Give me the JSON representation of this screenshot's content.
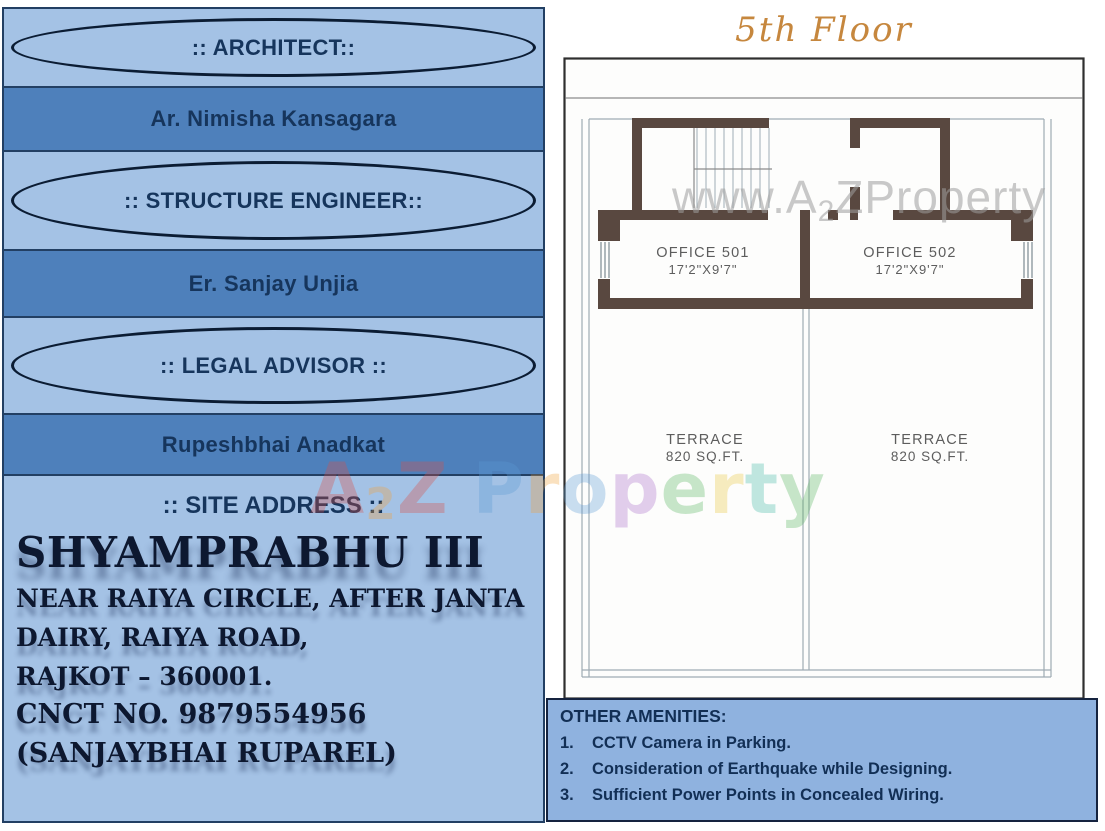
{
  "left_panel": {
    "sections": [
      {
        "role": "header",
        "label": ":: ARCHITECT::"
      },
      {
        "role": "value",
        "label": "Ar. Nimisha Kansagara"
      },
      {
        "role": "header",
        "label": ":: STRUCTURE ENGINEER::"
      },
      {
        "role": "value",
        "label": "Er. Sanjay Unjia"
      },
      {
        "role": "header",
        "label": ":: LEGAL ADVISOR ::"
      },
      {
        "role": "value",
        "label": "Rupeshbhai Anadkat"
      }
    ],
    "site": {
      "heading": ":: SITE ADDRESS ::",
      "project_name": "SHYAMPRABHU III",
      "address_lines": [
        "NEAR  RAIYA CIRCLE, AFTER JANTA",
        "DAIRY, RAIYA ROAD,",
        "RAJKOT – 360001."
      ],
      "contact_lines": [
        "CNCT NO. 9879554956",
        "(SANJAYBHAI RUPAREL)"
      ]
    }
  },
  "floor_plan": {
    "title": "5th Floor",
    "offices": [
      {
        "name": "OFFICE 501",
        "size": "17'2\"X9'7\""
      },
      {
        "name": "OFFICE 502",
        "size": "17'2\"X9'7\""
      }
    ],
    "terraces": [
      {
        "name": "TERRACE",
        "area": "820 SQ.FT."
      },
      {
        "name": "TERRACE",
        "area": "820 SQ.FT."
      }
    ]
  },
  "amenities": {
    "title": "OTHER AMENITIES:",
    "items": [
      {
        "num": "1.",
        "text": "CCTV Camera in Parking."
      },
      {
        "num": "2.",
        "text": "Consideration of Earthquake while Designing."
      },
      {
        "num": "3.",
        "text": "Sufficient Power Points in Concealed Wiring."
      }
    ]
  },
  "watermarks": {
    "plan": {
      "prefix": "www.A",
      "sub": "2",
      "suffix": "ZProperty"
    },
    "center_letters": [
      {
        "ch": "A",
        "style": "color:#d94f46"
      },
      {
        "ch": "2",
        "style": "color:#f2a33c;font-size:44px;position:relative;top:6px"
      },
      {
        "ch": "Z",
        "style": "color:#d94f46"
      },
      {
        "ch": "P",
        "style": "color:#5b9bd5;margin-left:24px"
      },
      {
        "ch": "r",
        "style": "color:#f2a33c"
      },
      {
        "ch": "o",
        "style": "color:#5b9bd5"
      },
      {
        "ch": "p",
        "style": "color:#a86bc9"
      },
      {
        "ch": "e",
        "style": "color:#56b45d"
      },
      {
        "ch": "r",
        "style": "color:#e8c63f"
      },
      {
        "ch": "t",
        "style": "color:#3fb8a5"
      },
      {
        "ch": "y",
        "style": "color:#56b45d"
      }
    ]
  },
  "colors": {
    "panel_light_blue": "#a4c2e5",
    "panel_dark_blue": "#4e80bb",
    "panel_border_navy": "#223f63",
    "text_navy": "#16355c",
    "wall_brown": "#594840",
    "title_orange": "#c6873e",
    "amenities_blue": "#8fb2df"
  }
}
